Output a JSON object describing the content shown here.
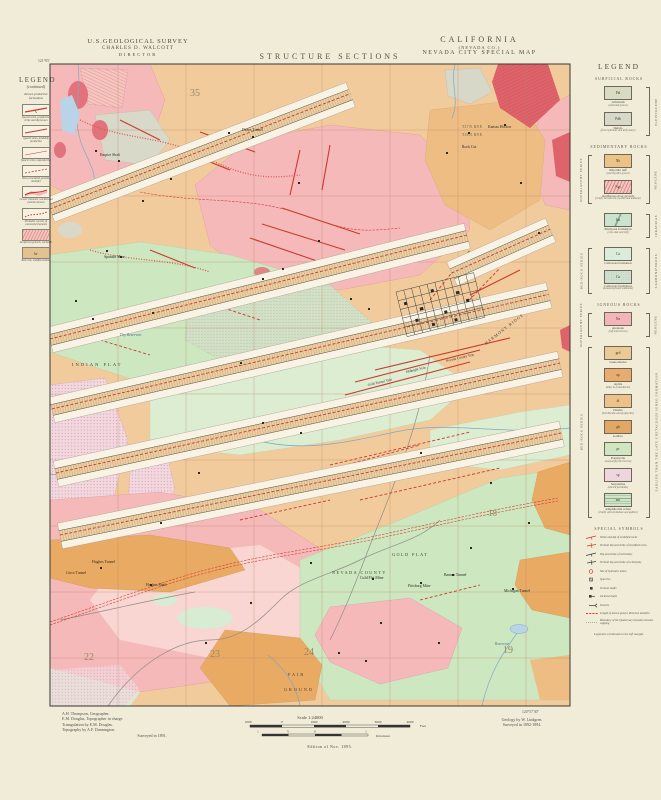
{
  "header": {
    "agency_line1": "U.S.GEOLOGICAL SURVEY",
    "agency_line2": "CHARLES D. WALCOTT",
    "agency_line3": "DIRECTOR",
    "sheet_title": "STRUCTURE SECTIONS",
    "state": "CALIFORNIA",
    "county": "(NEVADA CO.)",
    "map_title": "NEVADA CITY SPECIAL MAP"
  },
  "left_legend": {
    "title": "LEGEND",
    "subtitle": "(continued)",
    "heading": "Known productive formations",
    "items": [
      {
        "type": "vein-solid",
        "caption": "Quartz veins, productive, strike and dip known"
      },
      {
        "type": "vein-solid2",
        "caption": "Quartz veins, probably productive"
      },
      {
        "type": "vein-thin",
        "caption": "Quartz veins, unproductive"
      },
      {
        "type": "vein-dash",
        "caption": "Veins concealed, position doubtful"
      },
      {
        "type": "channel",
        "caption": "Gravel channels, worked and position known"
      },
      {
        "type": "channel-dash",
        "caption": "Probable courses of concealed channels"
      },
      {
        "type": "hatch",
        "caption": "Auriferous gravels, workable"
      },
      {
        "type": "bedrock",
        "caption": "Bed rock, undifferentiated",
        "code": "br"
      }
    ]
  },
  "right_legend": {
    "title": "LEGEND",
    "sections": {
      "surficial": "SURFICIAL ROCKS",
      "sedimentary": "SEDIMENTARY ROCKS",
      "igneous": "IGNEOUS ROCKS",
      "special": "SPECIAL SYMBOLS"
    },
    "series_labels": {
      "superjacent": "SUPERJACENT SERIES",
      "bedrock": "BED-ROCK SERIES"
    },
    "era_labels": {
      "pleistocene": "PLEISTOCENE",
      "neocene1": "NEOCENE",
      "juratrias": "JURATRIAS",
      "carboniferous": "CARBONIFEROUS",
      "neocene2": "NEOCENE",
      "cretaceous": "EARLIER THAN THE LATE CRETACEOUS IGNEO FORMATION"
    },
    "formations": [
      {
        "code": "Pal",
        "name": "Alluvium",
        "sub": "(sand and gravel)",
        "swatch": "alluvium"
      },
      {
        "code": "Pdb",
        "name": "Debris",
        "sub": "(from hydraulic and drift mines)",
        "swatch": "debris"
      },
      {
        "code": "Nh",
        "name": "Rhyolite tuff",
        "sub": "(and rhyolitic gravel)",
        "swatch": "rhyolite"
      },
      {
        "code": "Ngr",
        "name": "Auriferous river gravels",
        "sub": "(chiefly beneath the rhyolite and andesite)",
        "swatch": "gravel-hatch"
      },
      {
        "code": "Jm",
        "name": "Mariposa formation",
        "sub": "(clay slate and tuff)",
        "swatch": "mariposa"
      },
      {
        "code": "Ca",
        "name": "Calaveras formation",
        "sub": "",
        "swatch": "calaveras"
      },
      {
        "code": "Ca",
        "name": "Calaveras formation",
        "sub": "(metamorphosed sediments)",
        "swatch": "calaveras-meta"
      },
      {
        "code": "Na",
        "name": "Andesite",
        "sub": "(tuff and breccia)",
        "swatch": "andesite"
      },
      {
        "code": "grd",
        "name": "Granodiorite",
        "sub": "",
        "swatch": "granodiorite"
      },
      {
        "code": "ap",
        "name": "Aplite",
        "sub": "(dikes in granodiorite)",
        "swatch": "aplite"
      },
      {
        "code": "di",
        "name": "Diorite",
        "sub": "(hornblendic and porphyritic)",
        "swatch": "diorite"
      },
      {
        "code": "gb",
        "name": "Gabbro",
        "sub": "",
        "swatch": "gabbro"
      },
      {
        "code": "pr",
        "name": "Porphyrite",
        "sub": "(and porphyrite breccia)",
        "swatch": "porphyrite"
      },
      {
        "code": "sp",
        "name": "Serpentine",
        "sub": "(altered peridotite)",
        "swatch": "serpentine"
      },
      {
        "code": "am",
        "name": "Amphibolite schist",
        "sub": "(chiefly altered diabase and gabbro)",
        "swatch": "amphibolite"
      }
    ],
    "special_symbols": [
      {
        "sym": "strike",
        "caption": "Strike and dip of stratified rocks"
      },
      {
        "sym": "vstrike",
        "caption": "Vertical dip and strike of stratified rocks"
      },
      {
        "sym": "schist",
        "caption": "Dip and strike of schistosity"
      },
      {
        "sym": "vschist",
        "caption": "Vertical dip and strike of schistosity"
      },
      {
        "sym": "hyd",
        "caption": "Site of hydraulic mines"
      },
      {
        "sym": "quarry",
        "caption": "Quarries"
      },
      {
        "sym": "vshaft",
        "caption": "Vertical shafts"
      },
      {
        "sym": "ishaft",
        "caption": "Inclined shafts"
      },
      {
        "sym": "tunnel",
        "caption": "Tunnels"
      },
      {
        "sym": "gravel",
        "caption": "Length of known gravel, direction doubtful"
      },
      {
        "sym": "boundary",
        "caption": "Boundary of the Quaternary beneath volcanic capping"
      }
    ],
    "footnote": "Legend is continued on the left margin."
  },
  "map": {
    "labels": [
      {
        "t": "35",
        "x": 190,
        "y": 96,
        "s": 10,
        "cls": "sec"
      },
      {
        "t": "22",
        "x": 84,
        "y": 660,
        "s": 10,
        "cls": "sec"
      },
      {
        "t": "23",
        "x": 210,
        "y": 657,
        "s": 10,
        "cls": "sec"
      },
      {
        "t": "24",
        "x": 304,
        "y": 655,
        "s": 10,
        "cls": "sec"
      },
      {
        "t": "19",
        "x": 503,
        "y": 653,
        "s": 10,
        "cls": "sec"
      },
      {
        "t": "18",
        "x": 488,
        "y": 516,
        "s": 9,
        "cls": "sec"
      },
      {
        "t": "INDIAN FLAT",
        "x": 72,
        "y": 366,
        "s": 4.6,
        "sp": 2,
        "cls": "place"
      },
      {
        "t": "GOLD FLAT",
        "x": 392,
        "y": 556,
        "s": 4.2,
        "sp": 1.5,
        "cls": "place"
      },
      {
        "t": "NEVADA COUNTY",
        "x": 332,
        "y": 574,
        "s": 4.2,
        "sp": 1.5,
        "cls": "place"
      },
      {
        "t": "FAIR",
        "x": 288,
        "y": 676,
        "s": 4.2,
        "sp": 2,
        "cls": "place"
      },
      {
        "t": "GROUND",
        "x": 284,
        "y": 691,
        "s": 4.2,
        "sp": 2,
        "cls": "place"
      },
      {
        "t": "HARMONY RIDGE",
        "x": 486,
        "y": 345,
        "s": 4.2,
        "sp": 1,
        "r": -38,
        "cls": "place"
      },
      {
        "t": "Hughes Tunnel",
        "x": 92,
        "y": 563,
        "s": 3.8,
        "cls": "mine"
      },
      {
        "t": "Cerro Tunnel",
        "x": 66,
        "y": 574,
        "s": 3.8,
        "cls": "mine"
      },
      {
        "t": "Hughes Shaft",
        "x": 146,
        "y": 586,
        "s": 3.8,
        "cls": "mine"
      },
      {
        "t": "Pittsburg Mine",
        "x": 408,
        "y": 587,
        "s": 3.8,
        "cls": "mine"
      },
      {
        "t": "Gold Flat Mine",
        "x": 360,
        "y": 579,
        "s": 3.8,
        "cls": "mine"
      },
      {
        "t": "Banner Tunnel",
        "x": 444,
        "y": 576,
        "s": 3.8,
        "cls": "mine"
      },
      {
        "t": "Michigan Tunnel",
        "x": 504,
        "y": 592,
        "s": 3.8,
        "cls": "mine"
      },
      {
        "t": "Deans Tunnel",
        "x": 242,
        "y": 131,
        "s": 3.8,
        "cls": "mine"
      },
      {
        "t": "Kansas Hollow",
        "x": 488,
        "y": 128,
        "s": 3.8,
        "cls": "mine"
      },
      {
        "t": "Rock Cut",
        "x": 462,
        "y": 148,
        "s": 3.8,
        "cls": "mine"
      },
      {
        "t": "Spanish Mine",
        "x": 104,
        "y": 258,
        "s": 3.8,
        "cls": "mine"
      },
      {
        "t": "Empire Shaft",
        "x": 100,
        "y": 156,
        "s": 3.8,
        "cls": "mine"
      },
      {
        "t": "Dry Reservoir",
        "x": 120,
        "y": 336,
        "s": 3.8,
        "cls": "water-label"
      },
      {
        "t": "Reservoir",
        "x": 495,
        "y": 645,
        "s": 3.6,
        "cls": "water-label"
      },
      {
        "t": "Gold Tunnel Vein",
        "x": 368,
        "y": 386,
        "s": 3.5,
        "r": -13,
        "cls": "vein-label"
      },
      {
        "t": "Midnight Vein",
        "x": 406,
        "y": 373,
        "s": 3.5,
        "r": -13,
        "cls": "vein-label"
      },
      {
        "t": "Nevada County Vein",
        "x": 446,
        "y": 362,
        "s": 3.5,
        "r": -13,
        "cls": "vein-label"
      },
      {
        "t": "T.17 N.   R.9 E.",
        "x": 462,
        "y": 128,
        "s": 3.6,
        "cls": "township"
      },
      {
        "t": "T.16 N.   R.9 E.",
        "x": 462,
        "y": 136,
        "s": 3.6,
        "cls": "township"
      },
      {
        "t": "121°05'",
        "x": 38,
        "y": 62,
        "s": 3.8,
        "cls": "coord"
      },
      {
        "t": "120°57'30\"",
        "x": 522,
        "y": 713,
        "s": 3.8,
        "cls": "coord"
      }
    ]
  },
  "scale": {
    "label": "Scale",
    "ratio": "1:24000",
    "feet_ticks": [
      "1000",
      "0",
      "1000",
      "2000",
      "3000",
      "4000"
    ],
    "feet_unit": "Feet",
    "km_ticks": [
      "1",
      "½",
      "0",
      "1"
    ],
    "km_unit": "Kilometer",
    "edition": "Edition of Nov. 1895."
  },
  "credits": {
    "left": [
      "A.H. Thompson, Geographer.",
      "E.M. Douglas, Topographer in charge.",
      "Triangulation by E.M. Douglas.",
      "Topography by A.F. Dunnington.",
      "Surveyed in 1891."
    ],
    "right": [
      "Geology by W. Lindgren.",
      "Surveyed in 1892-1894."
    ]
  },
  "colors": {
    "paper": "#f1ecd8",
    "map_tan": "#f2cb9c",
    "pink_andesite": "#f5b9ba",
    "green": "#cde7c0",
    "crimson": "#df636b",
    "orange": "#e9aa64",
    "vein_red": "#c93a2e"
  }
}
